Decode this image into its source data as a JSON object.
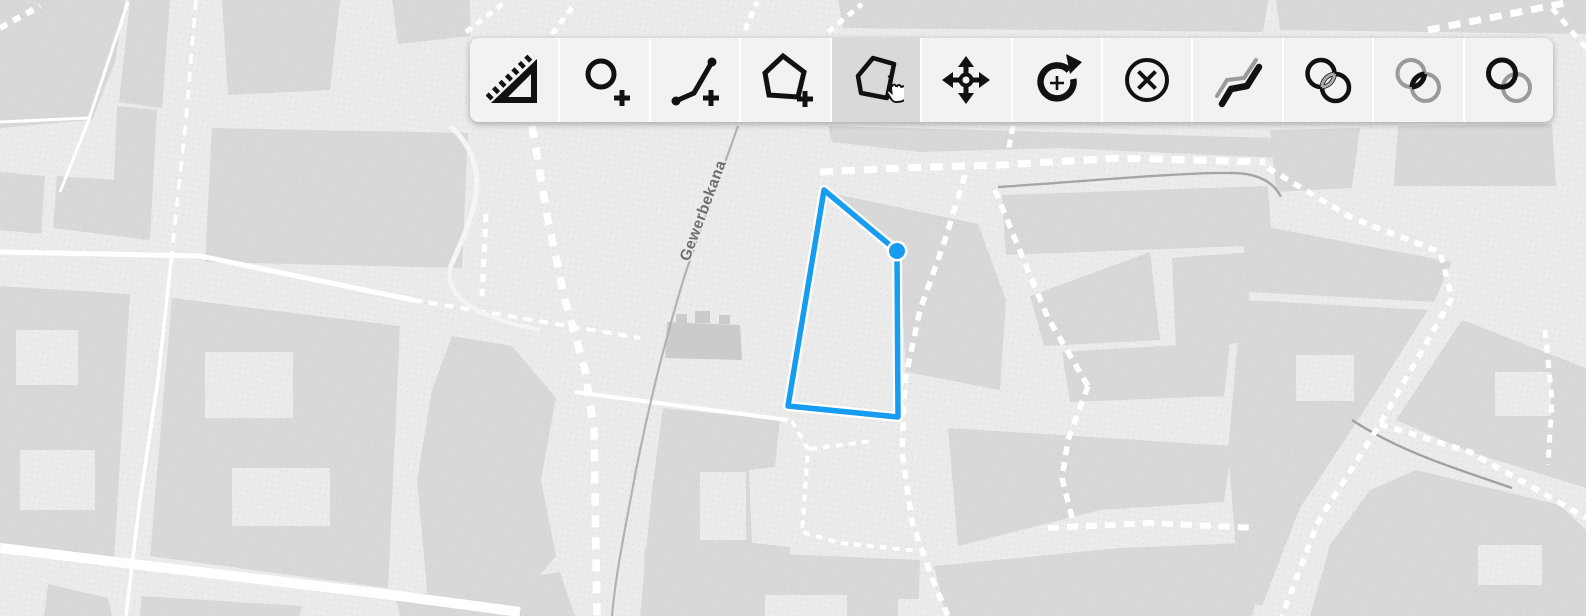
{
  "toolbar": {
    "buttons": [
      {
        "name": "measure",
        "icon": "ruler-triangle-icon",
        "active": false
      },
      {
        "name": "draw-point",
        "icon": "circle-plus-icon",
        "active": false
      },
      {
        "name": "draw-line",
        "icon": "polyline-plus-icon",
        "active": false
      },
      {
        "name": "draw-polygon",
        "icon": "polygon-plus-icon",
        "active": false
      },
      {
        "name": "modify",
        "icon": "polygon-hand-icon",
        "active": true
      },
      {
        "name": "move",
        "icon": "move-arrows-icon",
        "active": false
      },
      {
        "name": "rotate",
        "icon": "rotate-arrow-icon",
        "active": false
      },
      {
        "name": "delete",
        "icon": "circle-x-icon",
        "active": false
      },
      {
        "name": "topology",
        "icon": "offset-lines-icon",
        "active": false
      },
      {
        "name": "union",
        "icon": "union-circles-icon",
        "active": false
      },
      {
        "name": "intersection",
        "icon": "intersection-circles-icon",
        "active": false
      },
      {
        "name": "difference",
        "icon": "difference-circles-icon",
        "active": false
      }
    ]
  },
  "map": {
    "street_label": "Gewerbekana",
    "feature": {
      "type": "polygon",
      "stroke": "#169CF1",
      "vertices": [
        [
          824,
          190
        ],
        [
          897,
          251
        ],
        [
          898,
          417
        ],
        [
          788,
          406
        ]
      ],
      "selected_vertex": [
        897,
        251
      ]
    },
    "colors": {
      "background": "#ebebeb",
      "building": "#d8d8d8",
      "building_dark": "#cbcbcb",
      "road": "#ffffff",
      "canal": "#b2b2b2",
      "label": "#6e6e6e",
      "feature_blue": "#169CF1",
      "toolbar_bg": "#f2f2f2",
      "toolbar_active": "#d9d9d9"
    }
  }
}
